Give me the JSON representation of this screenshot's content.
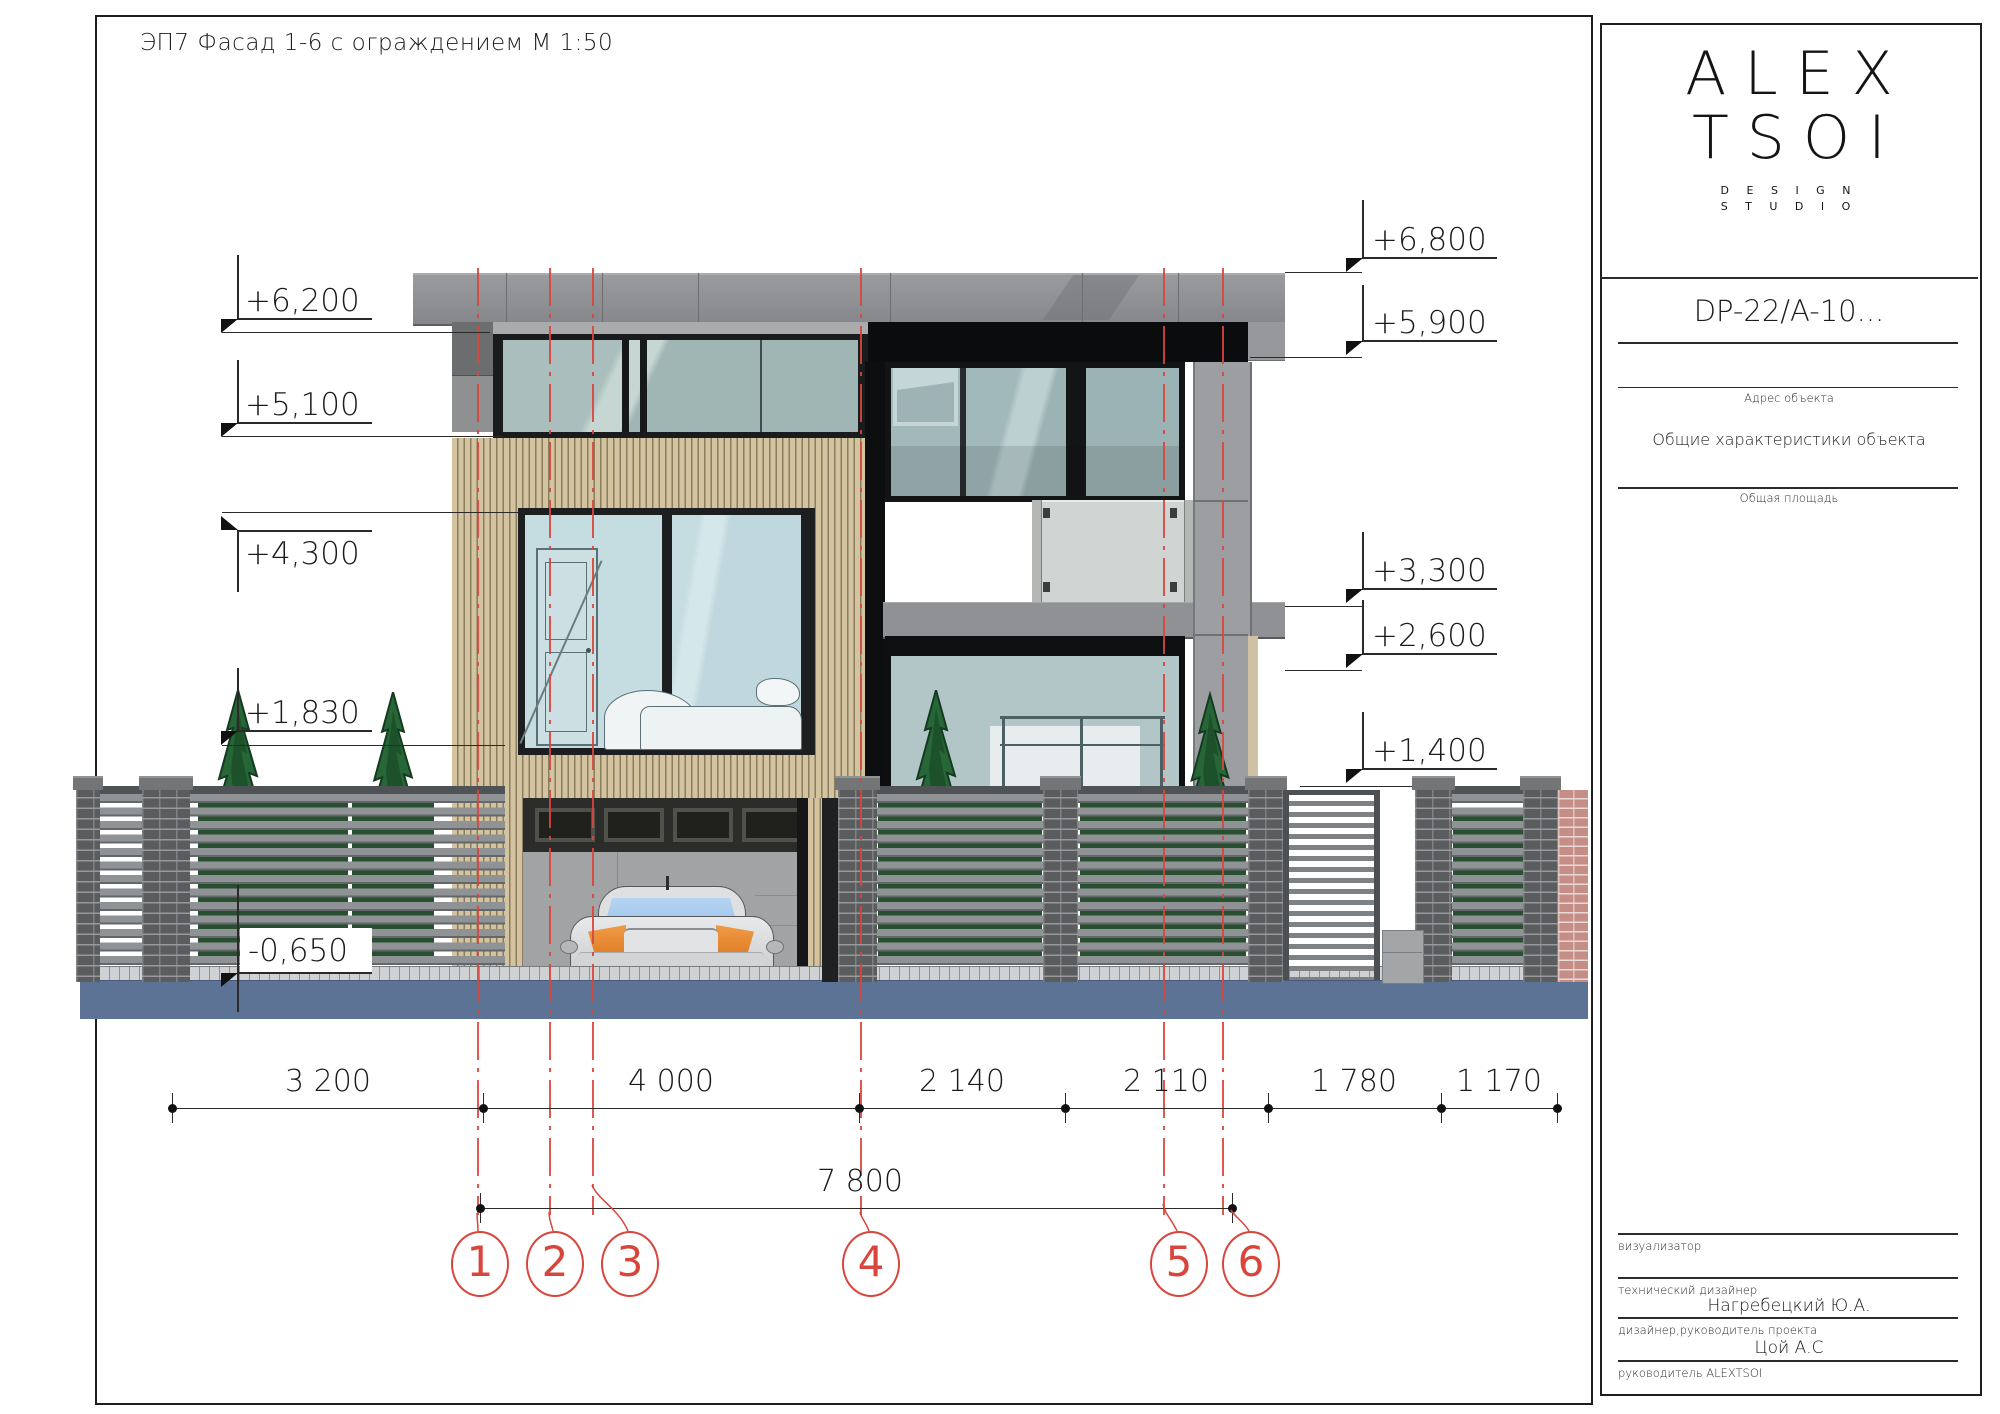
{
  "sheet_title": "ЭП7  Фасад 1-6 с ограждением М 1:50",
  "levels": {
    "l6800": "+6,800",
    "l6200": "+6,200",
    "l5900": "+5,900",
    "l5100": "+5,100",
    "l4300": "+4,300",
    "l3300": "+3,300",
    "l2600": "+2,600",
    "l1830": "+1,830",
    "l1400": "+1,400",
    "lm650": "-0,650"
  },
  "dimensions": {
    "d1": "3 200",
    "d2": "4 000",
    "d3": "2 140",
    "d4": "2 110",
    "d5": "1 780",
    "d6": "1 170",
    "total": "7 800"
  },
  "axes": {
    "a1": "1",
    "a2": "2",
    "a3": "3",
    "a4": "4",
    "a5": "5",
    "a6": "6"
  },
  "title_block": {
    "logo_line1": "ALEX",
    "logo_line2": "TSOI",
    "logo_sub1": "D E S I G N",
    "logo_sub2": "S T U D I O",
    "project_code": "DP-22/A-10...",
    "address_caption": "Адрес объекта",
    "characteristics_caption": "Общие характеристики объекта",
    "area_caption": "Общая площадь",
    "visualizer_caption": "визуализатор",
    "tech_designer_caption": "технический дизайнер",
    "tech_designer_name": "Нагребецкий Ю.А.",
    "lead_designer_caption": "дизайнер,руководитель проекта",
    "lead_designer_name": "Цой А.С",
    "head_caption": "руководитель ALEXTSOI"
  },
  "colors": {
    "ground_blue": "#5d7396",
    "axis_red": "#d8453c",
    "tree_green": "#266637",
    "wood_tan": "#d3c49f",
    "brick_pink": "#c48e87"
  }
}
